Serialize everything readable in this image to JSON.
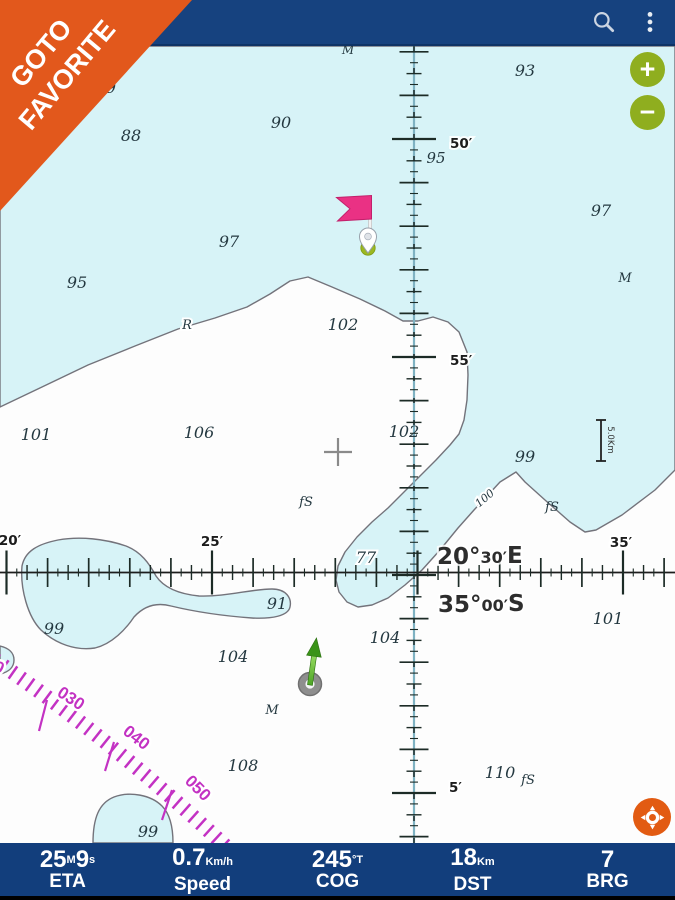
{
  "colors": {
    "appbar": "#16427f",
    "bottombar": "#123e7c",
    "water": "#d7f3f7",
    "contour": "#73737b",
    "rose": "#c332c3",
    "ribbon": "#e2581c",
    "btn_green": "#8fae1f",
    "locate": "#e25b12",
    "flag": "#ea3184",
    "pin_dot": "#9cb821"
  },
  "app_bar": {
    "icons": [
      {
        "name": "search"
      },
      {
        "name": "overflow-menu"
      }
    ]
  },
  "ribbon": {
    "lines": [
      "GOTO",
      "FAVORITE"
    ]
  },
  "zoom_controls": {
    "zoom_in_label": "+",
    "zoom_out_label": "−"
  },
  "map": {
    "graticule": {
      "vertical_x": 414,
      "horizontal_y": 572.5,
      "v_anchor_y": 139,
      "v_minute_px": 43.6,
      "h_anchor_x": 212,
      "h_minute_px": 41.1,
      "labels": [
        {
          "text": "50′",
          "x": 450,
          "y": 148,
          "anchor": "start"
        },
        {
          "text": "55′",
          "x": 450,
          "y": 365,
          "anchor": "start"
        },
        {
          "text": "5′",
          "x": 449,
          "y": 792,
          "anchor": "start"
        },
        {
          "text": "20′",
          "x": 10,
          "y": 545,
          "anchor": "middle"
        },
        {
          "text": "25′",
          "x": 212,
          "y": 546,
          "anchor": "middle"
        },
        {
          "text": "35′",
          "x": 621,
          "y": 547,
          "anchor": "middle"
        }
      ],
      "longitude_label": {
        "x": 437,
        "y": 564,
        "parts": [
          [
            "20°",
            "b"
          ],
          [
            "30′",
            "s"
          ],
          [
            "E",
            "b"
          ]
        ]
      },
      "latitude_label": {
        "x": 438,
        "y": 612,
        "parts": [
          [
            "35°",
            "b"
          ],
          [
            "00′",
            "s"
          ],
          [
            "S",
            "b"
          ]
        ]
      }
    },
    "scale_bar": {
      "text": "5.0Km"
    },
    "soundings": [
      {
        "t": "9",
        "x": 111,
        "y": 93
      },
      {
        "t": "88",
        "x": 131,
        "y": 141
      },
      {
        "t": "90",
        "x": 281,
        "y": 128
      },
      {
        "t": "M",
        "x": 348,
        "y": 54,
        "fs": 12
      },
      {
        "t": "93",
        "x": 525,
        "y": 76
      },
      {
        "t": "95",
        "x": 436,
        "y": 163,
        "fs": 15
      },
      {
        "t": "97",
        "x": 229,
        "y": 247
      },
      {
        "t": "97",
        "x": 601,
        "y": 216
      },
      {
        "t": "95",
        "x": 77,
        "y": 288
      },
      {
        "t": "M",
        "x": 625,
        "y": 282,
        "fs": 13
      },
      {
        "t": "R",
        "x": 187,
        "y": 329,
        "fs": 13,
        "halo": true
      },
      {
        "t": "102",
        "x": 343,
        "y": 330
      },
      {
        "t": "101",
        "x": 36,
        "y": 440
      },
      {
        "t": "106",
        "x": 199,
        "y": 438
      },
      {
        "t": "102",
        "x": 404,
        "y": 437
      },
      {
        "t": "99",
        "x": 525,
        "y": 462
      },
      {
        "t": "fS",
        "x": 306,
        "y": 506,
        "fs": 13
      },
      {
        "t": "fS",
        "x": 552,
        "y": 511,
        "fs": 13
      },
      {
        "t": "100",
        "x": 487,
        "y": 501,
        "fs": 11,
        "rot": -40,
        "halo": true
      },
      {
        "t": "77",
        "x": 366,
        "y": 563,
        "halo": true
      },
      {
        "t": "91",
        "x": 277,
        "y": 609
      },
      {
        "t": "99",
        "x": 54,
        "y": 634
      },
      {
        "t": "101",
        "x": 608,
        "y": 624
      },
      {
        "t": "104",
        "x": 385,
        "y": 643
      },
      {
        "t": "104",
        "x": 233,
        "y": 662
      },
      {
        "t": "M",
        "x": 272,
        "y": 714,
        "fs": 13
      },
      {
        "t": "108",
        "x": 243,
        "y": 771
      },
      {
        "t": "110",
        "x": 500,
        "y": 778
      },
      {
        "t": "fS",
        "x": 528,
        "y": 784,
        "fs": 13
      },
      {
        "t": "99",
        "x": 148,
        "y": 837
      }
    ],
    "rose_labels": [
      {
        "t": "020",
        "x": -12,
        "y": 668,
        "rot": 28
      },
      {
        "t": "030",
        "x": 68,
        "y": 703,
        "rot": 33
      },
      {
        "t": "040",
        "x": 133,
        "y": 742,
        "rot": 38
      },
      {
        "t": "050",
        "x": 194,
        "y": 792,
        "rot": 45
      }
    ]
  },
  "bottom_bar": {
    "stats": [
      {
        "label": "ETA",
        "parts": [
          [
            "25",
            "n"
          ],
          [
            "M",
            "sup"
          ],
          [
            "9",
            "n"
          ],
          [
            "s",
            "sup"
          ]
        ]
      },
      {
        "label": "Speed",
        "parts": [
          [
            "0.7",
            "n"
          ],
          [
            "Km/h",
            "sub"
          ]
        ]
      },
      {
        "label": "COG",
        "parts": [
          [
            "245",
            "n"
          ],
          [
            "°T",
            "sup"
          ]
        ]
      },
      {
        "label": "DST",
        "parts": [
          [
            "18",
            "n"
          ],
          [
            "Km",
            "sub"
          ]
        ]
      },
      {
        "label": "BRG",
        "parts": [
          [
            "7",
            "n"
          ]
        ]
      }
    ]
  }
}
